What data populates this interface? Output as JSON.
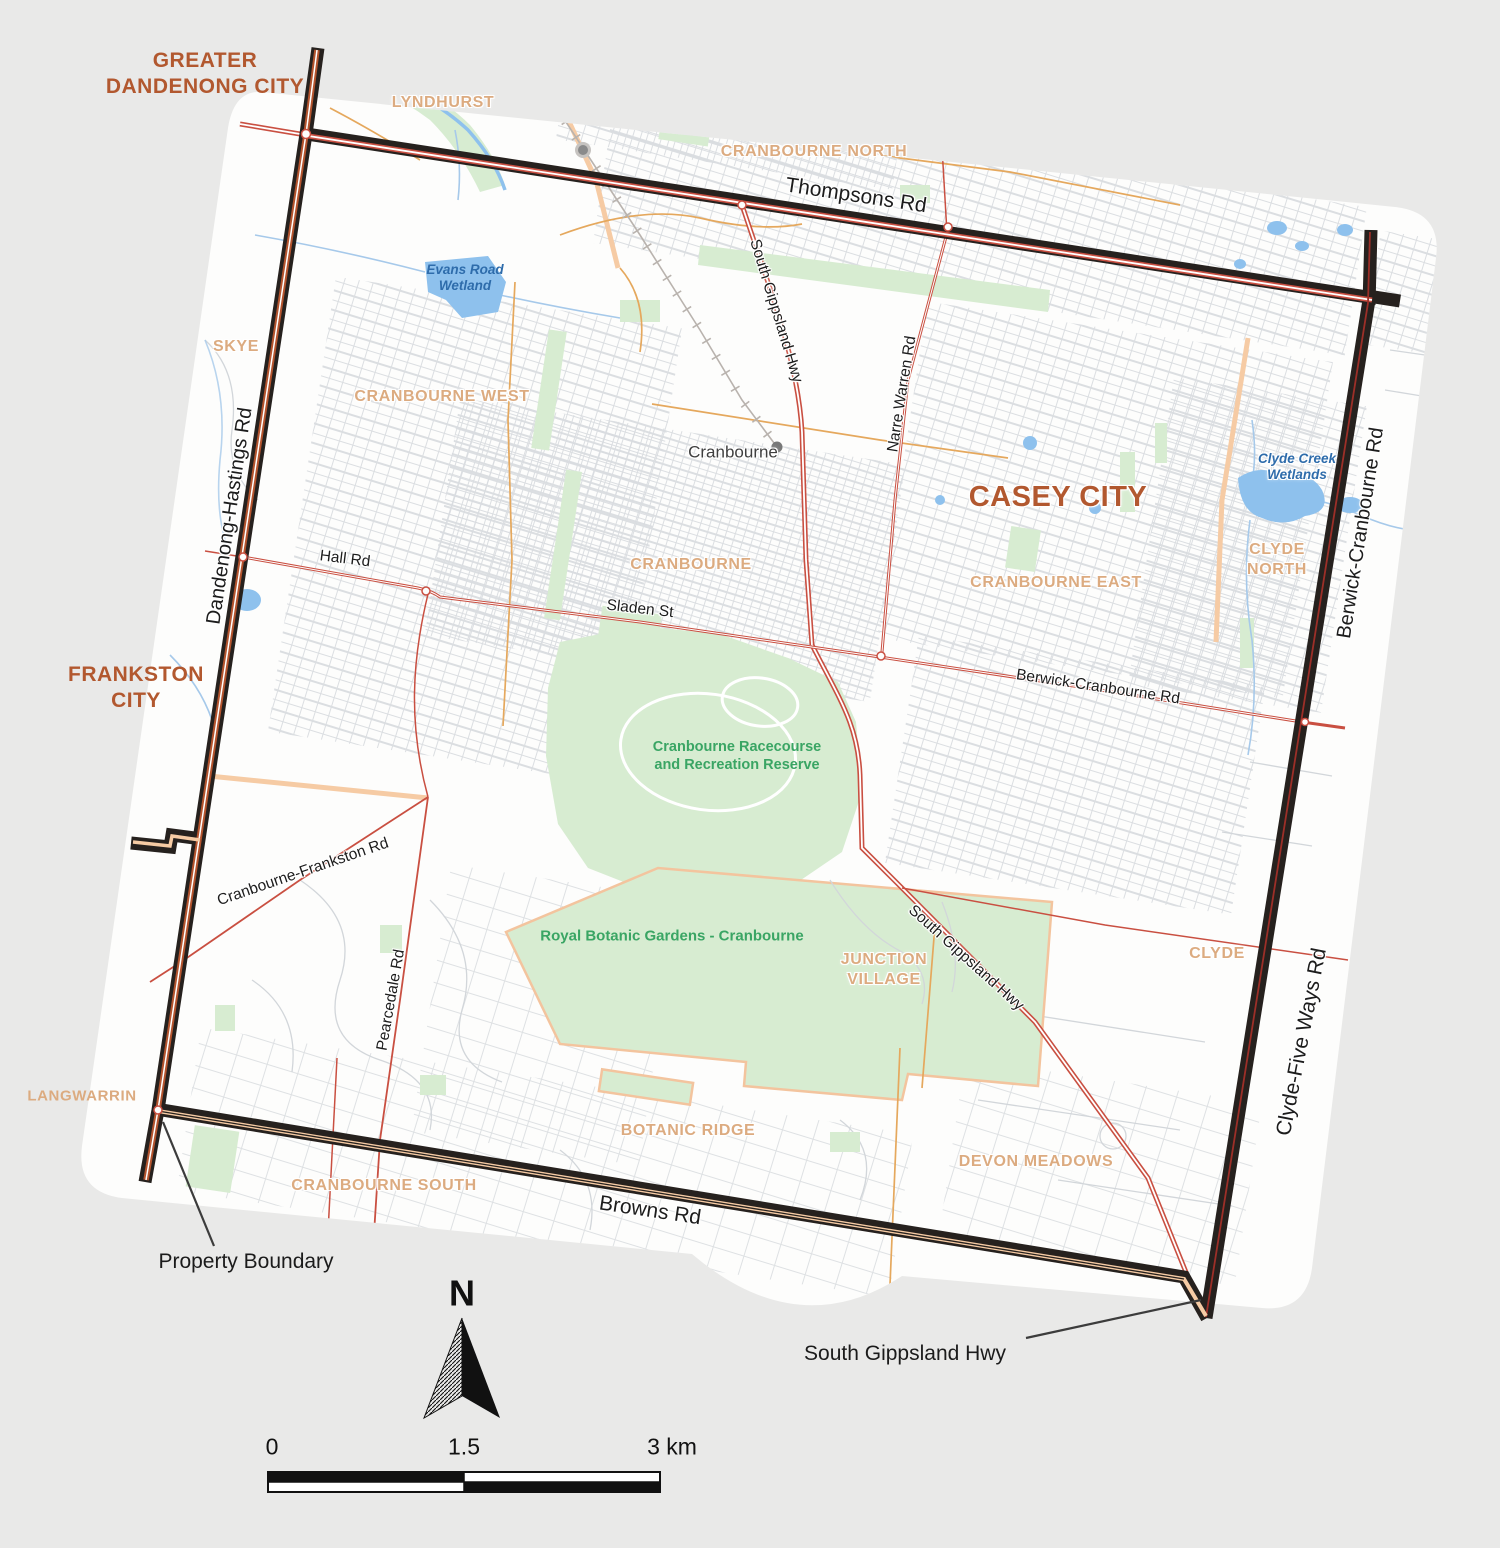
{
  "colors": {
    "background": "#e9e9e8",
    "map_base": "#fdfdfc",
    "property_boundary": "#26211e",
    "city_label": "#b2582f",
    "suburb_label": "#dcab80",
    "road_red": "#c94f41",
    "road_orange": "#e5a85d",
    "road_peach": "#f6cba4",
    "park_green": "#d7ecd1",
    "park_label": "#3aa564",
    "water_blue": "#8ec1ed",
    "water_label": "#2e6cab",
    "minor_street": "#d9dce0",
    "railway": "#b9b3ae"
  },
  "map": {
    "labels": [
      {
        "id": "greater-dandenong-city",
        "text": "GREATER\nDANDENONG CITY",
        "kind": "city"
      },
      {
        "id": "frankston-city",
        "text": "FRANKSTON\nCITY",
        "kind": "city"
      },
      {
        "id": "casey-city",
        "text": "CASEY CITY",
        "kind": "city"
      },
      {
        "id": "lyndhurst",
        "text": "LYNDHURST",
        "kind": "suburb"
      },
      {
        "id": "cranbourne-north",
        "text": "CRANBOURNE NORTH",
        "kind": "suburb"
      },
      {
        "id": "skye",
        "text": "SKYE",
        "kind": "suburb"
      },
      {
        "id": "cranbourne-west",
        "text": "CRANBOURNE WEST",
        "kind": "suburb"
      },
      {
        "id": "cranbourne-suburb",
        "text": "CRANBOURNE",
        "kind": "suburb"
      },
      {
        "id": "cranbourne-east",
        "text": "CRANBOURNE EAST",
        "kind": "suburb"
      },
      {
        "id": "clyde-north",
        "text": "CLYDE\nNORTH",
        "kind": "suburb"
      },
      {
        "id": "clyde",
        "text": "CLYDE",
        "kind": "suburb"
      },
      {
        "id": "junction-village",
        "text": "JUNCTION\nVILLAGE",
        "kind": "suburb"
      },
      {
        "id": "botanic-ridge",
        "text": "BOTANIC RIDGE",
        "kind": "suburb"
      },
      {
        "id": "devon-meadows",
        "text": "DEVON MEADOWS",
        "kind": "suburb"
      },
      {
        "id": "cranbourne-south",
        "text": "CRANBOURNE SOUTH",
        "kind": "suburb"
      },
      {
        "id": "langwarrin",
        "text": "LANGWARRIN",
        "kind": "suburb"
      },
      {
        "id": "evans-road-wetland",
        "text": "Evans Road\nWetland",
        "kind": "water-t"
      },
      {
        "id": "clyde-creek-wetlands",
        "text": "Clyde Creek\nWetlands",
        "kind": "water-t"
      },
      {
        "id": "cranbourne-racecourse",
        "text": "Cranbourne Racecourse\nand Recreation Reserve",
        "kind": "park-t"
      },
      {
        "id": "royal-botanic-gardens",
        "text": "Royal Botanic Gardens - Cranbourne",
        "kind": "park-t"
      },
      {
        "id": "cranbourne-town",
        "text": "Cranbourne",
        "kind": "town"
      },
      {
        "id": "thompsons-rd",
        "text": "Thompsons Rd",
        "kind": "road"
      },
      {
        "id": "dandenong-hastings-rd",
        "text": "Dandenong-Hastings Rd",
        "kind": "road"
      },
      {
        "id": "hall-rd",
        "text": "Hall Rd",
        "kind": "road"
      },
      {
        "id": "sladen-st",
        "text": "Sladen St",
        "kind": "road"
      },
      {
        "id": "berwick-cranbourne-rd-mid",
        "text": "Berwick-Cranbourne Rd",
        "kind": "road"
      },
      {
        "id": "south-gippsland-hwy-n",
        "text": "South Gippsland Hwy",
        "kind": "road"
      },
      {
        "id": "narre-warren-rd",
        "text": "Narre Warren Rd",
        "kind": "road"
      },
      {
        "id": "berwick-cranbourne-rd-e",
        "text": "Berwick-Cranbourne Rd",
        "kind": "road"
      },
      {
        "id": "cranbourne-frankston-rd",
        "text": "Cranbourne-Frankston Rd",
        "kind": "road"
      },
      {
        "id": "pearcedale-rd",
        "text": "Pearcedale Rd",
        "kind": "road"
      },
      {
        "id": "south-gippsland-hwy-s",
        "text": "South Gippsland Hwy",
        "kind": "road"
      },
      {
        "id": "browns-rd",
        "text": "Browns Rd",
        "kind": "road"
      },
      {
        "id": "clyde-five-ways-rd",
        "text": "Clyde-Five Ways Rd",
        "kind": "road"
      },
      {
        "id": "property-boundary-label",
        "text": "Property Boundary",
        "kind": "annotation"
      },
      {
        "id": "south-gippsland-hwy-callout",
        "text": "South Gippsland Hwy",
        "kind": "annotation"
      },
      {
        "id": "north-label",
        "text": "N",
        "kind": "north"
      },
      {
        "id": "scale-0",
        "text": "0",
        "kind": "legend"
      },
      {
        "id": "scale-mid",
        "text": "1.5",
        "kind": "legend"
      },
      {
        "id": "scale-end",
        "text": "3 km",
        "kind": "legend"
      }
    ]
  }
}
